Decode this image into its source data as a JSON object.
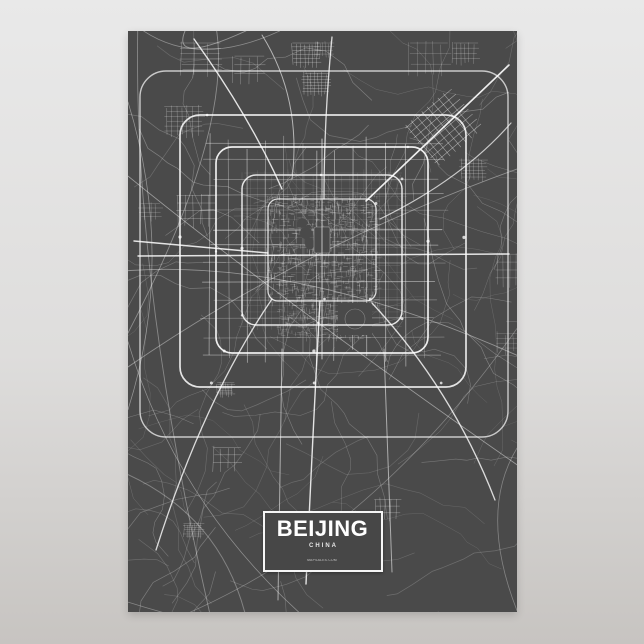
{
  "poster": {
    "title": "BEIJING",
    "subtitle": "CHINA",
    "watermark": "MAPSALES.COM"
  },
  "colors": {
    "wall_top": "#e9e9e9",
    "wall_mid": "#dedddc",
    "wall_bottom": "#c7c4c1",
    "poster_background": "#4a4a4a",
    "road": "#ffffff",
    "plate_background": "#474747",
    "plate_border": "#f5f5f5",
    "title_text": "#ffffff",
    "subtitle_text": "#e6e6e6",
    "watermark_text": "#cccccc"
  }
}
